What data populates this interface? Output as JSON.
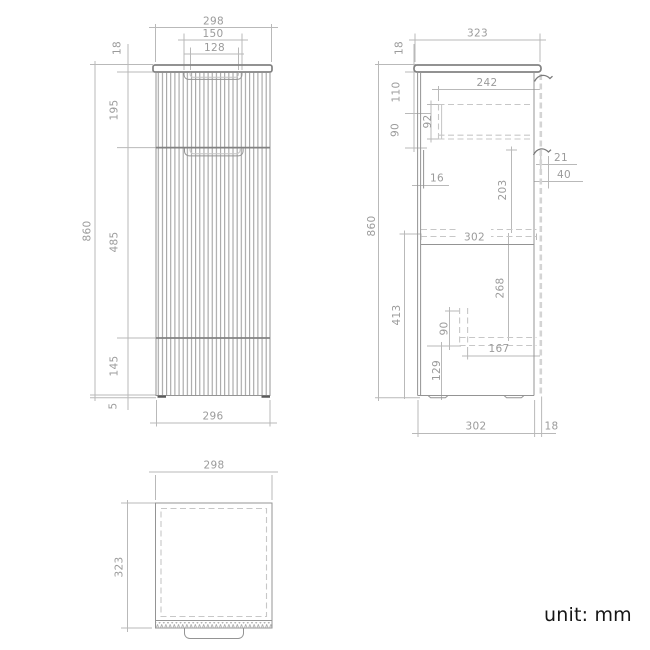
{
  "unit_label": "unit: mm",
  "colors": {
    "object_line": "#949494",
    "dimension_line": "#b9b9b9",
    "dimension_text": "#9b9b9b",
    "hidden_line": "#c7c7c7",
    "unit_text": "#161616",
    "background": "#ffffff"
  },
  "front_view": {
    "width_top": "298",
    "handle_outer_width": "150",
    "handle_inner_width": "128",
    "countertop_thickness": "18",
    "drawer_front_height": "195",
    "door_height": "485",
    "lower_panel_height": "145",
    "plinth_height": "5",
    "total_height": "860",
    "width_bottom": "296"
  },
  "side_view": {
    "depth_top": "323",
    "countertop_thickness": "18",
    "top_offset": "110",
    "upper_clearance": "90",
    "drawer_depth": "242",
    "drawer_box_height": "92",
    "back_clearance": "16",
    "handle_lip_depth": "21",
    "handle_recess_depth": "40",
    "upper_cavity_height": "203",
    "internal_depth": "302",
    "lower_cavity_height": "268",
    "lower_section_height": "413",
    "bracket_height": "90",
    "bracket_depth": "167",
    "plinth_zone_height": "129",
    "depth_bottom": "302",
    "front_panel_thickness": "18",
    "total_height": "860"
  },
  "top_view": {
    "width": "298",
    "depth": "323"
  }
}
